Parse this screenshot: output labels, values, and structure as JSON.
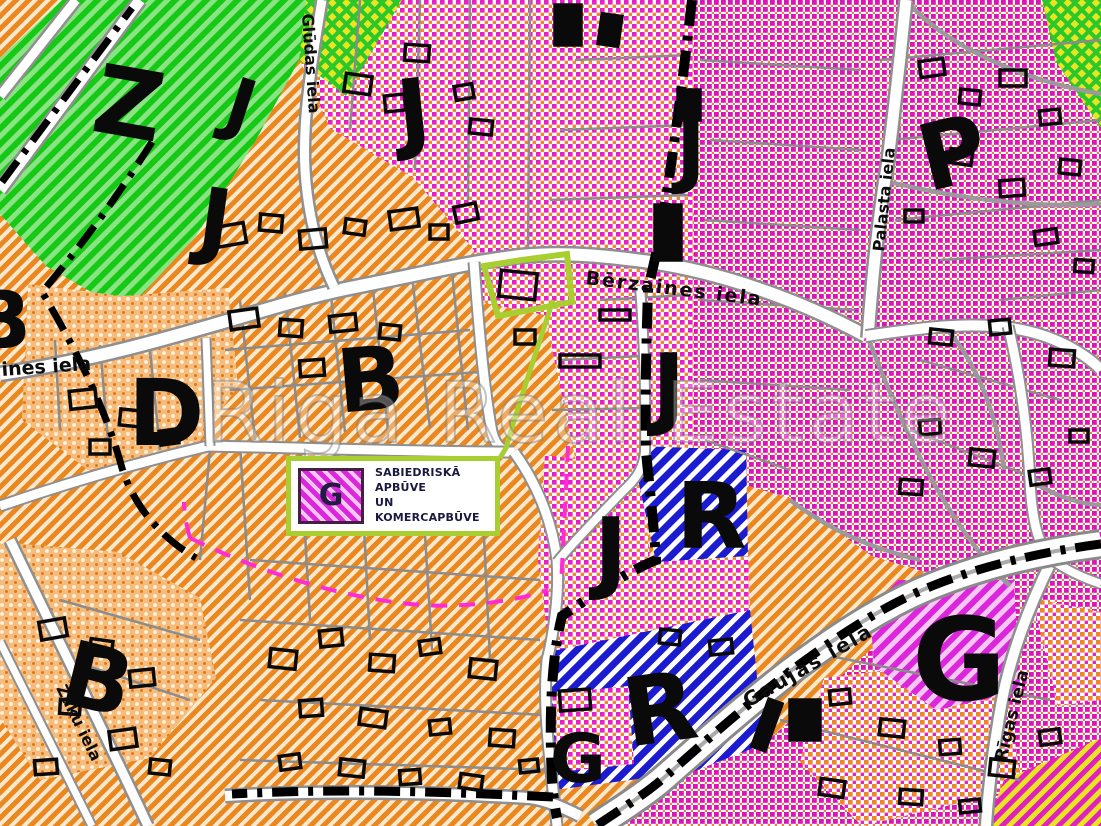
{
  "streets": {
    "berzaines": "Bērzaines iela",
    "ines": "ines iela",
    "gludas": "Glūdas iela",
    "palasta": "Palasta iela",
    "rigas": "Rīgas iela",
    "gaujas": "Gaujas iela",
    "zaku": "Zaķu iela"
  },
  "zone_labels": [
    "Z",
    "J",
    "J",
    "J",
    "J",
    "P",
    "B",
    "D",
    "B",
    "J",
    "J",
    "R",
    "R",
    "G",
    "B",
    "G"
  ],
  "legend": {
    "symbol": "G",
    "line1": "SABIEDRISKĀ APBŪVE",
    "line2": "UN KOMERCAPBŪVE"
  },
  "watermark": "Riga Real Estate",
  "colors": {
    "highlight": "#A8CE2F",
    "zone_magenta": "#EA1EC6",
    "zone_orange": "#EA871E",
    "zone_green": "#17C917",
    "zone_blue": "#1B1BD0",
    "zone_g_stripe": "#DC26DC",
    "road": "#FFFFFF"
  }
}
